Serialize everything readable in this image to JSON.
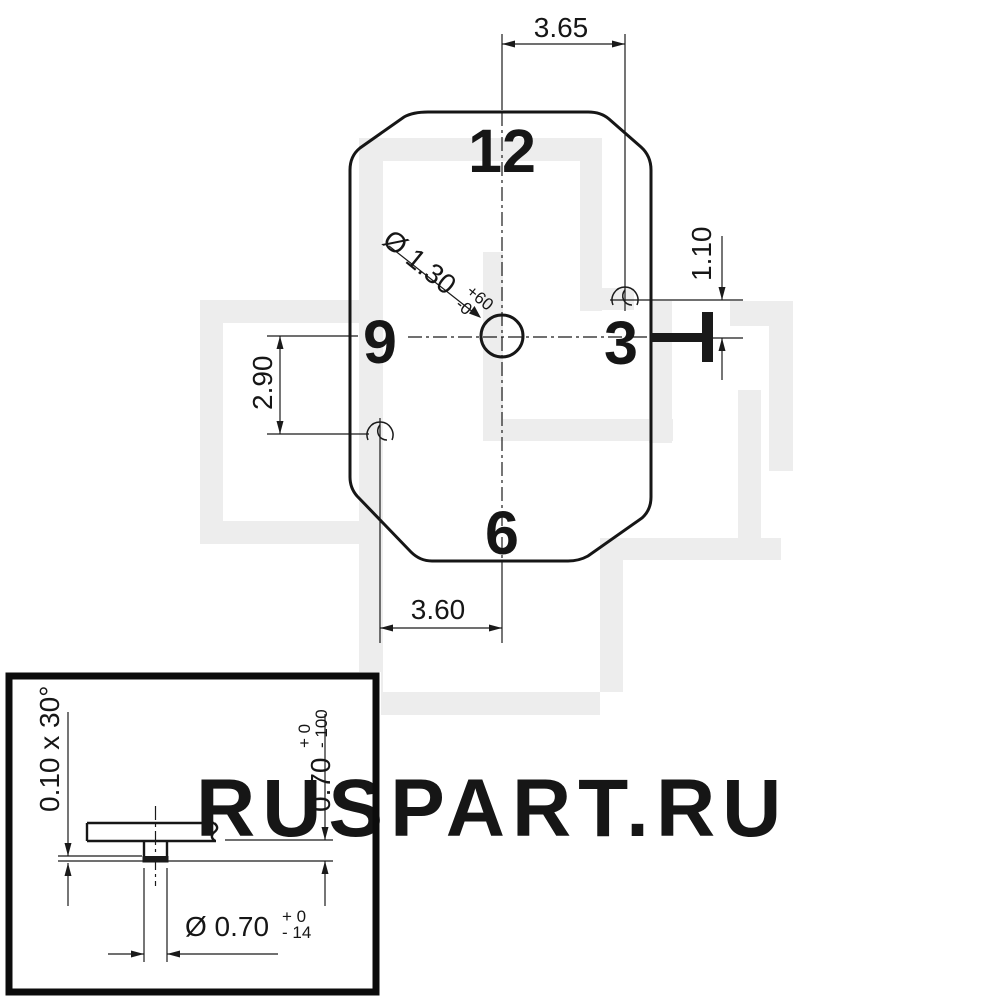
{
  "watermark": {
    "text": "RUSPART.RU"
  },
  "main_view": {
    "numbers": {
      "n12": "12",
      "n9": "9",
      "n3": "3",
      "n6": "6"
    },
    "dims": {
      "top": "3.65",
      "right": "1.10",
      "left": "2.90",
      "bottom": "3.60",
      "hole": {
        "label": "Ø 1.30",
        "tol_plus": "+60",
        "tol_minus": "-0"
      }
    }
  },
  "detail_view": {
    "chamfer": "0.10 x 30°",
    "height": {
      "label": "0.70",
      "tol_plus": "+ 0",
      "tol_minus": "- 100"
    },
    "diameter": {
      "label": "Ø 0.70",
      "tol_plus": "+ 0",
      "tol_minus": "- 14"
    }
  }
}
